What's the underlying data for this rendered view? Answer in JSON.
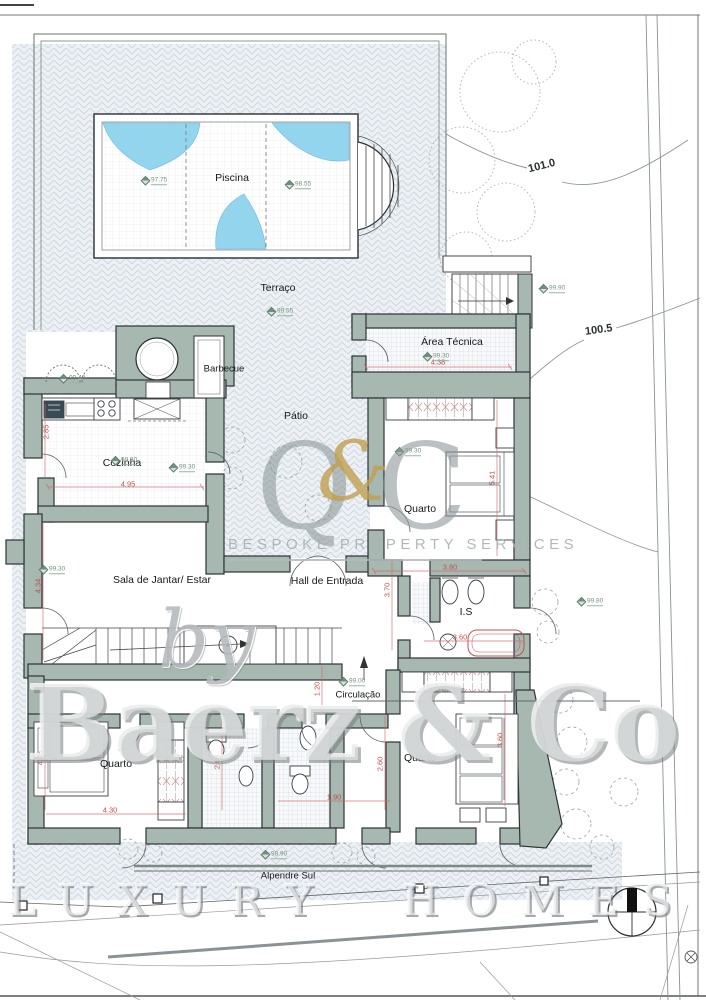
{
  "plan": {
    "labels": {
      "piscina": "Piscina",
      "terraco": "Terraço",
      "barbecue": "Barbecue",
      "patio": "Pátio",
      "area_tecnica": "Área Técnica",
      "cozinha": "Cozinha",
      "quarto_1": "Quarto",
      "sala": "Sala de Jantar/ Estar",
      "hall": "Hall de Entrada",
      "is_1": "I.S",
      "circulacao": "Circulação",
      "quarto_2": "Quarto",
      "quarto_3": "Quarto",
      "alpendre": "Alpendre Sul"
    },
    "contours": {
      "c101": "101.0",
      "c100_5": "100.5"
    },
    "dims": [
      {
        "v": "2.85"
      },
      {
        "v": "4.95"
      },
      {
        "v": "4.38"
      },
      {
        "v": "5.41"
      },
      {
        "v": "3.80"
      },
      {
        "v": "4.34"
      },
      {
        "v": "3.70"
      },
      {
        "v": "3.60"
      },
      {
        "v": "1.20"
      },
      {
        "v": "2.68"
      },
      {
        "v": "2.60"
      },
      {
        "v": "1.90"
      },
      {
        "v": "3.60"
      },
      {
        "v": "4.05"
      },
      {
        "v": "4.30"
      }
    ],
    "elevations": [
      {
        "v": "97.75"
      },
      {
        "v": "98.55"
      },
      {
        "v": "99.55"
      },
      {
        "v": "99.30"
      },
      {
        "v": "99.30"
      },
      {
        "v": "99.30"
      },
      {
        "v": "99.30"
      },
      {
        "v": "99.30"
      },
      {
        "v": "99.00"
      },
      {
        "v": "99.80"
      },
      {
        "v": "98.90"
      },
      {
        "v": "99.90"
      },
      {
        "v": "99.40"
      }
    ]
  },
  "watermarks": {
    "q": "Q",
    "amp": "&",
    "c": "C",
    "tagline": "BESPOKE PROPERTY SERVICES",
    "by": "by",
    "brand": "Baerz & Co",
    "footer": "LUXURY HOMES"
  },
  "colors": {
    "wall": "#a6b8b0",
    "water": "#8fd3ee",
    "dimension": "#c0504d",
    "hatch": "#cdd8e0",
    "elevation": "#76937f",
    "gold": "#c2a04f",
    "watermark_gray": "#8f999b"
  }
}
